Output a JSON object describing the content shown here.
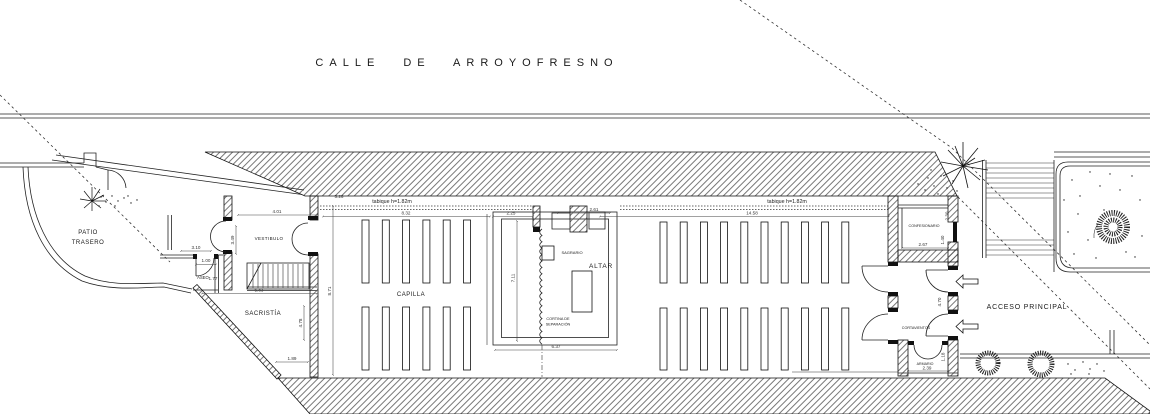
{
  "street": "CALLE DE ARROYOFRESNO",
  "labels": [
    {
      "id": "patio-trasero",
      "lines": [
        "PATIO",
        "TRASERO"
      ],
      "x": 88,
      "y": 234,
      "fs": 6,
      "lh": 10,
      "ls": 0.5
    },
    {
      "id": "vestibulo",
      "text": "VESTIBULO",
      "x": 269,
      "y": 240,
      "fs": 4.5,
      "ls": 0.4
    },
    {
      "id": "aseo",
      "text": "ASEO",
      "x": 203,
      "y": 279,
      "fs": 4.2,
      "ls": 0
    },
    {
      "id": "sacristia",
      "text": "SACRISTÍA",
      "x": 263,
      "y": 315,
      "fs": 6,
      "ls": 0.5
    },
    {
      "id": "capilla",
      "text": "CAPILLA",
      "x": 411,
      "y": 296,
      "fs": 6,
      "ls": 0.5
    },
    {
      "id": "sagrario",
      "text": "SAGRARIO",
      "x": 572,
      "y": 254,
      "fs": 4,
      "ls": 0
    },
    {
      "id": "altar",
      "text": "ALTAR",
      "x": 601,
      "y": 268,
      "fs": 6.5,
      "ls": 0.8
    },
    {
      "id": "cortina-separacion",
      "lines": [
        "CORTINA DE",
        "SEPARACIÓN"
      ],
      "x": 558,
      "y": 320,
      "fs": 3.8,
      "lh": 5.5,
      "ls": 0
    },
    {
      "id": "confesionario",
      "text": "CONFESIONARIO",
      "x": 924,
      "y": 227,
      "fs": 3.7,
      "ls": 0
    },
    {
      "id": "cortavientos",
      "text": "CORTAVIENTOS",
      "x": 916,
      "y": 329,
      "fs": 3.7,
      "ls": 0
    },
    {
      "id": "armario",
      "text": "ARMARIO",
      "x": 925,
      "y": 365,
      "fs": 3.6,
      "ls": 0
    },
    {
      "id": "acceso-principal",
      "text": "ACCESO PRINCIPAL",
      "x": 1027,
      "y": 309,
      "fs": 7,
      "ls": 0.8
    },
    {
      "id": "tabique-left",
      "text": "tabique h=1.82m",
      "x": 392,
      "y": 203,
      "fs": 5.3,
      "ls": 0
    },
    {
      "id": "tabique-right",
      "text": "tabique h=1.82m",
      "x": 787,
      "y": 203,
      "fs": 5.3,
      "ls": 0
    }
  ],
  "dimensions": [
    {
      "v": "3.10",
      "x": 196,
      "y": 249,
      "r": 0
    },
    {
      "v": "1.00",
      "x": 206,
      "y": 262,
      "r": 0
    },
    {
      "v": "1.77",
      "x": 213,
      "y": 280,
      "r": 0
    },
    {
      "v": "3.49",
      "x": 234,
      "y": 240,
      "r": 1
    },
    {
      "v": "4.01",
      "x": 277,
      "y": 213,
      "r": 0
    },
    {
      "v": "5.83",
      "x": 259,
      "y": 291.5,
      "r": 0
    },
    {
      "v": "8.71",
      "x": 331,
      "y": 291,
      "r": 1
    },
    {
      "v": "4.78",
      "x": 302,
      "y": 323,
      "r": 1
    },
    {
      "v": "1.89",
      "x": 292,
      "y": 360,
      "r": 0
    },
    {
      "v": "5.26",
      "x": 339,
      "y": 198,
      "r": 0
    },
    {
      "v": "8.32",
      "x": 406,
      "y": 214.5,
      "r": 0
    },
    {
      "v": "2.25",
      "x": 511,
      "y": 214.5,
      "r": 0
    },
    {
      "v": "2.61",
      "x": 594,
      "y": 211,
      "r": 0
    },
    {
      "v": "7.11",
      "x": 514.5,
      "y": 278,
      "r": 1
    },
    {
      "v": "6.37",
      "x": 556,
      "y": 348,
      "r": 0
    },
    {
      "v": "14.58",
      "x": 752,
      "y": 214.5,
      "r": 0
    },
    {
      "v": "2.67",
      "x": 923,
      "y": 246,
      "r": 0
    },
    {
      "v": "2.30",
      "x": 948.5,
      "y": 216,
      "r": 1
    },
    {
      "v": "1.40",
      "x": 944,
      "y": 240,
      "r": 1
    },
    {
      "v": "4.70",
      "x": 941,
      "y": 302,
      "r": 1
    },
    {
      "v": "1.18",
      "x": 944.5,
      "y": 357,
      "r": 1
    },
    {
      "v": "2.39",
      "x": 927,
      "y": 369.5,
      "r": 0
    }
  ],
  "pews": {
    "left_block": {
      "rows": 2,
      "benches_per_row": 6
    },
    "right_block": {
      "rows": 2,
      "benches_per_row": 10
    }
  },
  "icons": {
    "entrance_arrows": {
      "name": "left-block-arrow",
      "count": 2,
      "meaning": "entry direction at ACCESO PRINCIPAL"
    }
  },
  "colors": {
    "line": "#111111",
    "dim": "#333333",
    "background": "#ffffff"
  }
}
